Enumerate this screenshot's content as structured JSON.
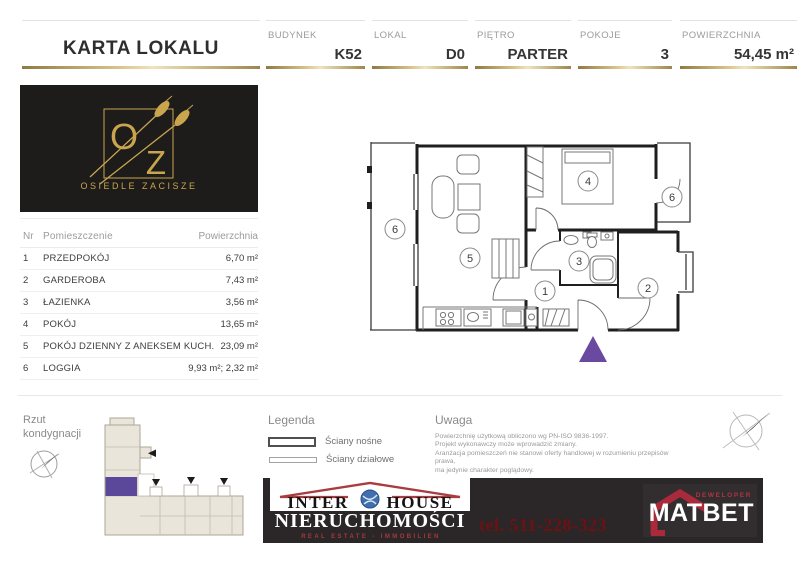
{
  "header": {
    "title": "KARTA LOKALU",
    "fields": [
      {
        "label": "BUDYNEK",
        "value": "K52"
      },
      {
        "label": "LOKAL",
        "value": "D0"
      },
      {
        "label": "PIĘTRO",
        "value": "PARTER"
      },
      {
        "label": "POKOJE",
        "value": "3"
      },
      {
        "label": "POWIERZCHNIA",
        "value": "54,45 m²"
      }
    ]
  },
  "estate_logo": {
    "letter_o": "O",
    "letter_z": "Z",
    "name": "OSIEDLE ZACISZE"
  },
  "rooms_table": {
    "col_nr": "Nr",
    "col_name": "Pomieszczenie",
    "col_area": "Powierzchnia",
    "rows": [
      {
        "nr": "1",
        "name": "PRZEDPOKÓJ",
        "area": "6,70 m²"
      },
      {
        "nr": "2",
        "name": "GARDEROBA",
        "area": "7,43 m²"
      },
      {
        "nr": "3",
        "name": "ŁAZIENKA",
        "area": "3,56 m²"
      },
      {
        "nr": "4",
        "name": "POKÓJ",
        "area": "13,65 m²"
      },
      {
        "nr": "5",
        "name": "POKÓJ DZIENNY Z ANEKSEM KUCH.",
        "area": "23,09 m²"
      },
      {
        "nr": "6",
        "name": "LOGGIA",
        "area": "9,93 m²; 2,32 m²"
      }
    ]
  },
  "floor_plan": {
    "labels": [
      "6",
      "5",
      "4",
      "6",
      "3",
      "1",
      "2"
    ]
  },
  "floor_section": {
    "rzut_line1": "Rzut",
    "rzut_line2": "kondygnacji"
  },
  "legend": {
    "title": "Legenda",
    "item1": "Ściany nośne",
    "item2": "Ściany działowe"
  },
  "uwaga": {
    "title": "Uwaga",
    "line1": "Powierzchnię użytkową obliczono wg PN-ISO 9836-1997.",
    "line2": "Projekt wykonawczy może wprowadzić zmiany.",
    "line3": "Aranżacja pomieszczeń nie stanowi oferty handlowej w rozumieniu przepisów prawa,",
    "line4": "ma jedynie charakter poglądowy."
  },
  "footer": {
    "interhouse": {
      "word1": "INTER",
      "word2": "HOUSE",
      "line2": "NIERUCHOMOŚCI",
      "line3": "REAL ESTATE - IMMOBILIEN"
    },
    "phone": "tel. 511-228-323",
    "matbet": {
      "tagline": "DEWELOPER",
      "name": "MATBET"
    }
  },
  "colors": {
    "gold": "#b59a54",
    "logo_gold": "#c9a54e",
    "purple_marker": "#6a4aa0",
    "purple_unit": "#5b489b",
    "banner_red": "#a93c3e",
    "phone_red": "#6d1113",
    "matbet_red": "#aa2a3c",
    "building_beige": "#eae5da"
  }
}
